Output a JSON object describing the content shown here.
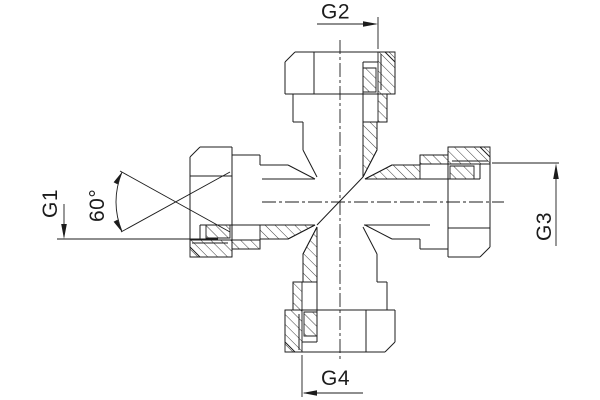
{
  "annotations": {
    "g1": {
      "label": "G1",
      "meaning": "left port thread callout"
    },
    "g2": {
      "label": "G2",
      "meaning": "top port thread callout"
    },
    "g3": {
      "label": "G3",
      "meaning": "right port thread callout"
    },
    "g4": {
      "label": "G4",
      "meaning": "bottom port thread callout"
    },
    "angle": {
      "label": "60°",
      "meaning": "sealing cone angle of left port"
    }
  },
  "drawing": {
    "subject": "cross fitting with four swivel nuts, half-sectioned",
    "ports": [
      {
        "id": "top",
        "callout": "G2"
      },
      {
        "id": "right",
        "callout": "G3"
      },
      {
        "id": "bottom",
        "callout": "G4"
      },
      {
        "id": "left",
        "callout": "G1"
      }
    ]
  },
  "style": {
    "line_color": "#1c1c1c",
    "background": "#ffffff"
  }
}
